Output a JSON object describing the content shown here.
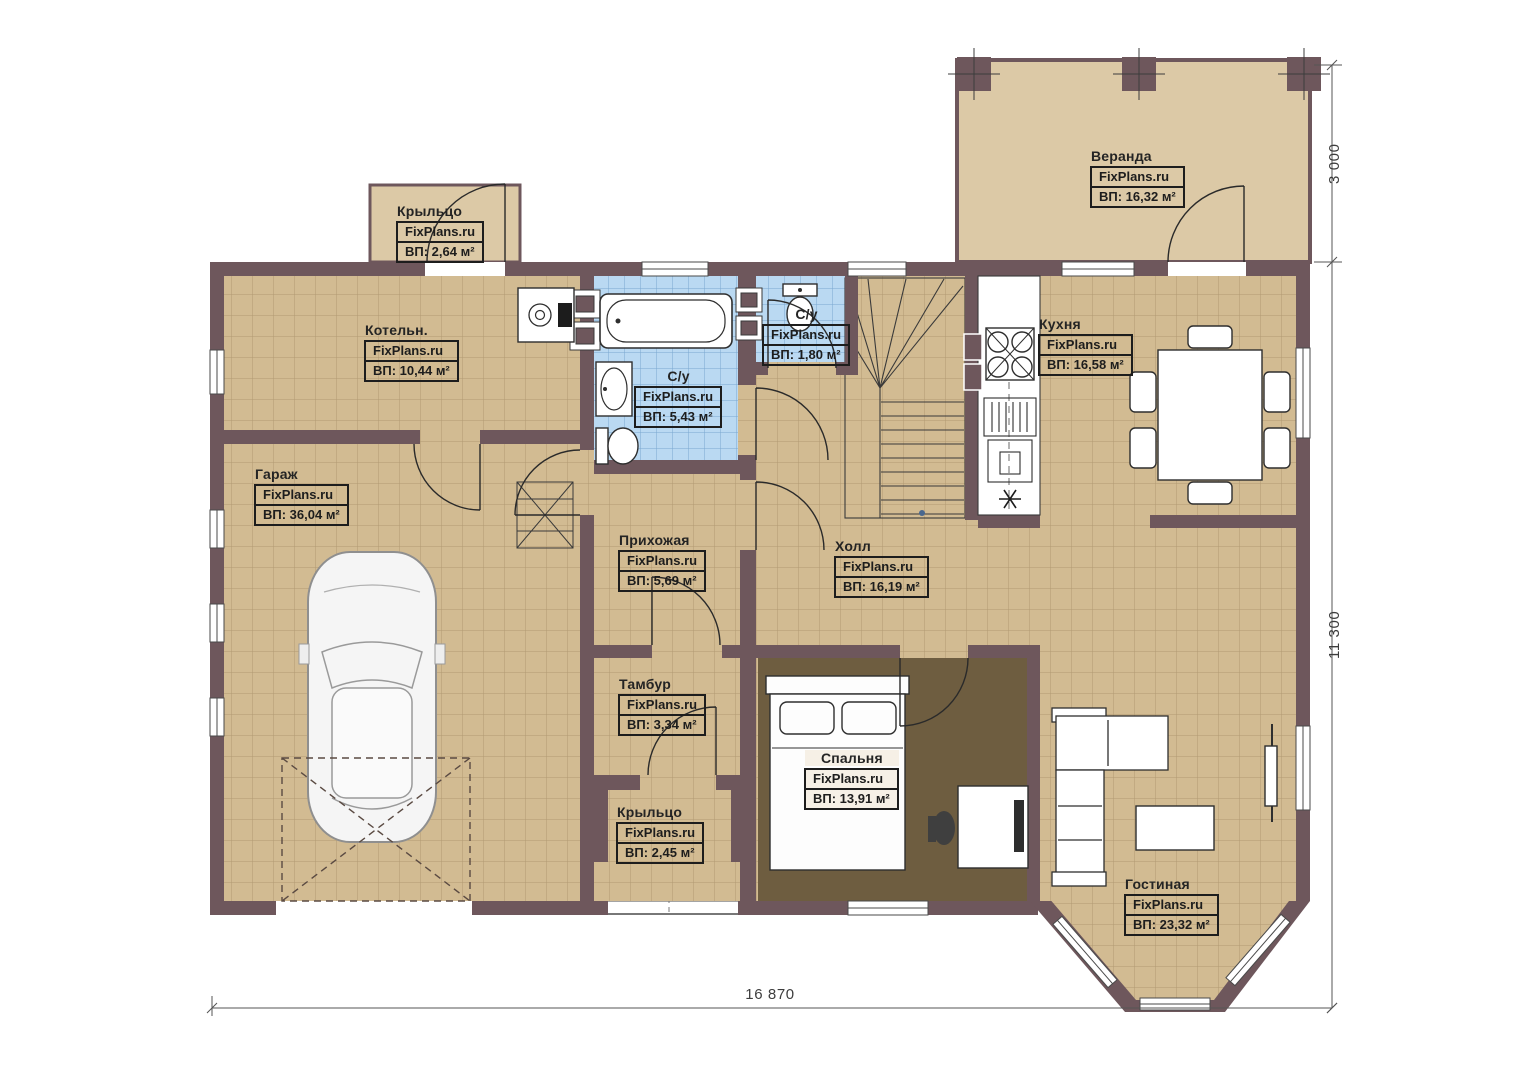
{
  "plan": {
    "brand": "FixPlans.ru",
    "colors": {
      "wall": "#6e575c",
      "floor_tile_tan": "#d2bb92",
      "floor_tile_blue": "#bad9f2",
      "floor_bedroom": "#6e5d40",
      "floor_veranda": "#dcc9a6",
      "label_text": "#1d1d1d",
      "dimension_text": "#3d3d3d"
    },
    "rooms": [
      {
        "id": "veranda",
        "name": "Веранда",
        "brand": "FixPlans.ru",
        "area": "ВП: 16,32 м²"
      },
      {
        "id": "kryltso-top",
        "name": "Крыльцо",
        "brand": "FixPlans.ru",
        "area": "ВП: 2,64 м²"
      },
      {
        "id": "kotelnaya",
        "name": "Котельн.",
        "brand": "FixPlans.ru",
        "area": "ВП: 10,44 м²"
      },
      {
        "id": "su-small",
        "name": "С/у",
        "brand": "FixPlans.ru",
        "area": "ВП: 1,80 м²"
      },
      {
        "id": "kuhnya",
        "name": "Кухня",
        "brand": "FixPlans.ru",
        "area": "ВП: 16,58 м²"
      },
      {
        "id": "su-big",
        "name": "С/у",
        "brand": "FixPlans.ru",
        "area": "ВП: 5,43 м²"
      },
      {
        "id": "garazh",
        "name": "Гараж",
        "brand": "FixPlans.ru",
        "area": "ВП: 36,04 м²"
      },
      {
        "id": "prihozhaya",
        "name": "Прихожая",
        "brand": "FixPlans.ru",
        "area": "ВП: 5,69 м²"
      },
      {
        "id": "holl",
        "name": "Холл",
        "brand": "FixPlans.ru",
        "area": "ВП: 16,19 м²"
      },
      {
        "id": "tambur",
        "name": "Тамбур",
        "brand": "FixPlans.ru",
        "area": "ВП: 3,34 м²"
      },
      {
        "id": "spalnya",
        "name": "Спальня",
        "brand": "FixPlans.ru",
        "area": "ВП: 13,91 м²"
      },
      {
        "id": "kryltso-bottom",
        "name": "Крыльцо",
        "brand": "FixPlans.ru",
        "area": "ВП: 2,45 м²"
      },
      {
        "id": "gostinaya",
        "name": "Гостиная",
        "brand": "FixPlans.ru",
        "area": "ВП: 23,32 м²"
      }
    ],
    "dimensions": {
      "bottom_width": "16 870",
      "right_main_height": "11 300",
      "right_veranda_depth": "3 000"
    }
  }
}
